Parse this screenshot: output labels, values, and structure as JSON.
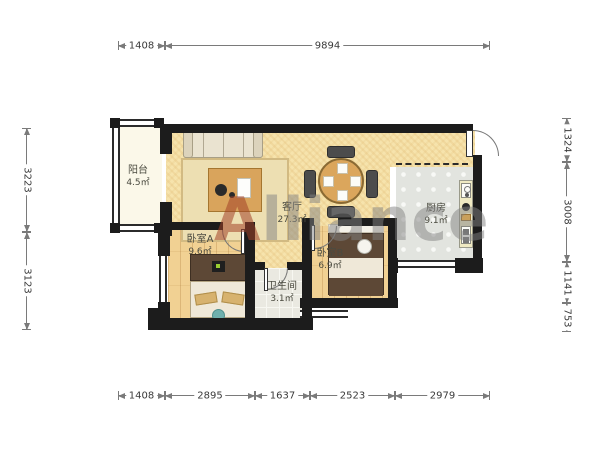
{
  "watermark": {
    "first_letter": "A",
    "rest": "lliance"
  },
  "rooms": {
    "balcony": {
      "name": "阳台",
      "area": "4.5㎡"
    },
    "living": {
      "name": "客厅",
      "area": "27.3㎡"
    },
    "kitchen": {
      "name": "厨房",
      "area": "9.1㎡"
    },
    "bedroom_a": {
      "name": "卧室A",
      "area": "9.6㎡"
    },
    "bedroom_b": {
      "name": "卧室B",
      "area": "6.9㎡"
    },
    "bathroom": {
      "name": "卫生间",
      "area": "3.1㎡"
    }
  },
  "dimensions": {
    "top": [
      "1408",
      "9894"
    ],
    "bottom": [
      "1408",
      "2895",
      "1637",
      "2523",
      "2979"
    ],
    "left": [
      "3223",
      "3123"
    ],
    "right": [
      "1324",
      "3008",
      "1141",
      "753"
    ]
  },
  "colors": {
    "wall": "#1c1c1c",
    "living_floor": "#f6e3ac",
    "wood_floor": "#f1d193",
    "kitchen_tile": "#e2e4df",
    "bath_tile": "#eae9e1",
    "balcony_floor": "#fbf8e9",
    "watermark_gray": "#828282",
    "watermark_red": "#a34228",
    "dimension_line": "#7a7a7a"
  }
}
